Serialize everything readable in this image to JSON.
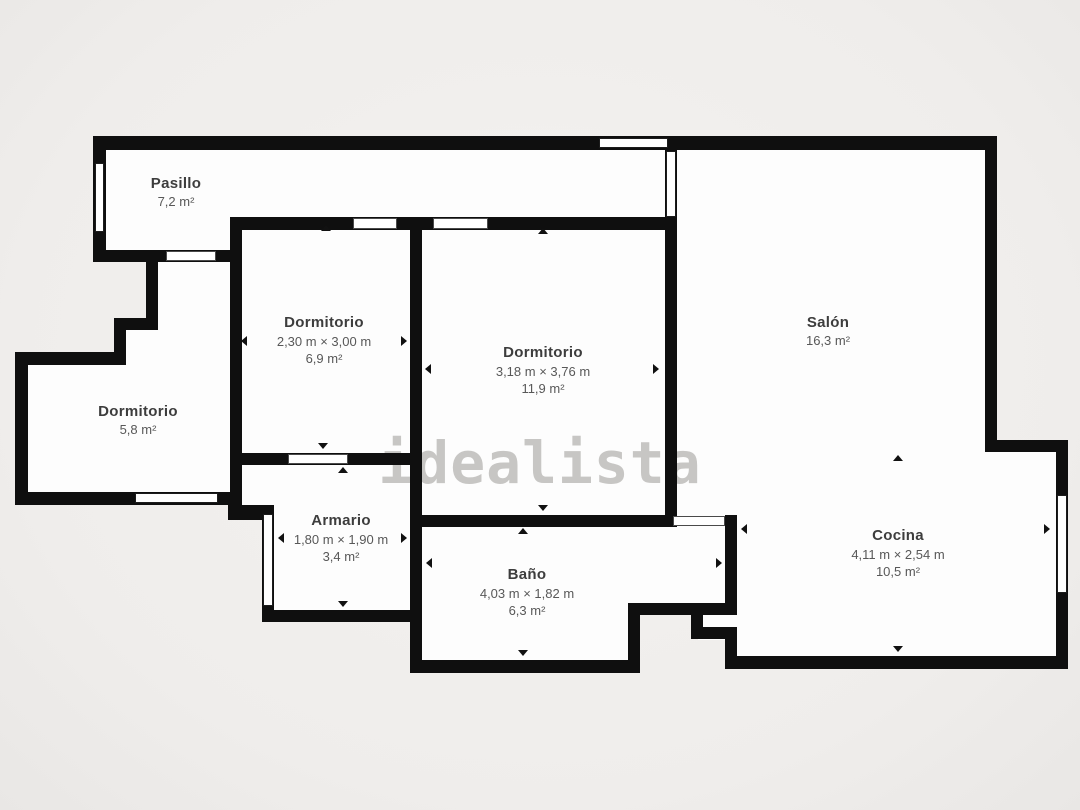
{
  "watermark_text": "idealista",
  "rooms": {
    "pasillo": {
      "name": "Pasillo",
      "area": "7,2 m²"
    },
    "dormitorio_top": {
      "name": "Dormitorio",
      "dimensions": "2,30 m × 3,00 m",
      "area": "6,9 m²"
    },
    "dormitorio_center": {
      "name": "Dormitorio",
      "dimensions": "3,18 m × 3,76 m",
      "area": "11,9 m²"
    },
    "salon": {
      "name": "Salón",
      "area": "16,3 m²"
    },
    "dormitorio_left": {
      "name": "Dormitorio",
      "area": "5,8 m²"
    },
    "armario": {
      "name": "Armario",
      "dimensions": "1,80 m × 1,90 m",
      "area": "3,4 m²"
    },
    "bano": {
      "name": "Baño",
      "dimensions": "4,03 m × 1,82 m",
      "area": "6,3 m²"
    },
    "cocina": {
      "name": "Cocina",
      "dimensions": "4,11 m × 2,54 m",
      "area": "10,5 m²"
    }
  },
  "colors": {
    "background": "#f1efed",
    "floor": "#fdfdfd",
    "wall": "#0f0f0f",
    "room_name_text": "#3d3d3d",
    "room_detail_text": "#585858",
    "watermark": "#c7c6c4"
  }
}
